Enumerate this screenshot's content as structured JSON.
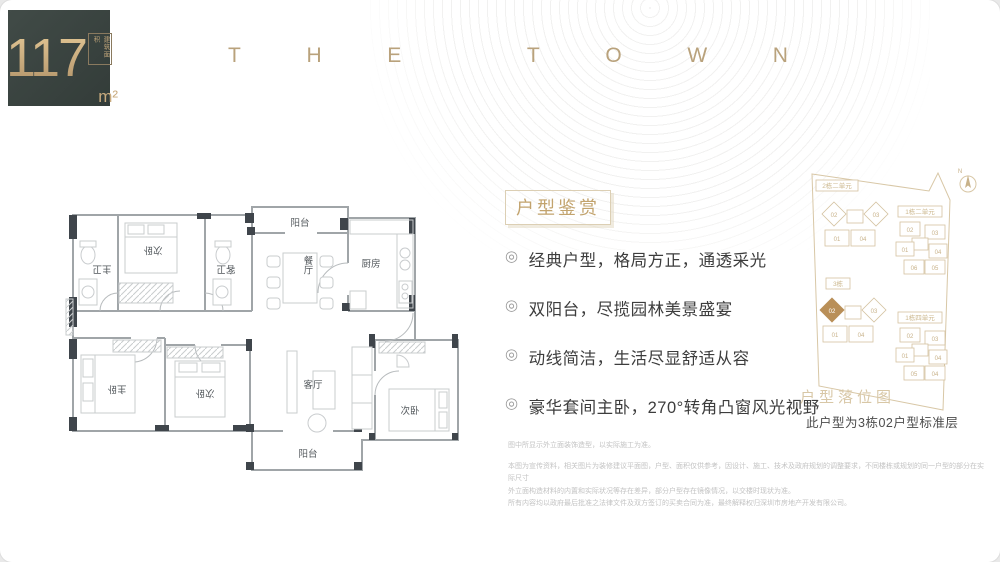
{
  "area_badge": {
    "value": "117",
    "unit": "m²",
    "note": "建筑面积"
  },
  "brand": {
    "letters": [
      "T",
      "H",
      "E",
      "T",
      "O",
      "W",
      "N"
    ]
  },
  "floorplan": {
    "rooms": {
      "balcony_top": "阳台",
      "dining": "餐厅",
      "kitchen": "厨房",
      "bedroom_top": "次卧",
      "master_bath": "主卫",
      "guest_bath": "客卫",
      "master_bed": "主卧",
      "bedroom_mid": "次卧",
      "living": "客厅",
      "bedroom_right": "次卧",
      "balcony_bottom": "阳台"
    }
  },
  "features": {
    "title": "户型鉴赏",
    "bullet_icon": "◎",
    "items": [
      "经典户型，格局方正，通透采光",
      "双阳台，尽揽园林美景盛宴",
      "动线简洁，生活尽显舒适从容",
      "豪华套间主卧，270°转角凸窗风光视野"
    ]
  },
  "sitemap": {
    "title": "户型落位图",
    "note": "此户型为3栋02户型标准层",
    "compass": "N",
    "clusters": [
      {
        "label": "2栋二单元",
        "units": [
          "02",
          "03",
          "01",
          "04"
        ]
      },
      {
        "label": "3栋",
        "units": [
          "02",
          "03",
          "01",
          "04"
        ],
        "highlight": "02"
      },
      {
        "label": "1栋二单元",
        "units": [
          "02",
          "03",
          "01",
          "04",
          "06",
          "05"
        ]
      },
      {
        "label": "1栋四单元",
        "units": [
          "02",
          "03",
          "01",
          "04",
          "05",
          "04"
        ]
      }
    ]
  },
  "disclaimer": {
    "line1": "图中所显示外立面装饰造型，以实际施工为准。",
    "line2": "本图为宣传资料，相关图片为装修建议平面图，户型、面积仅供参考，因设计、施工、技术及政府规划的调整要求，不同楼栋或规划的同一户型的部分在实际尺寸",
    "line3": "外立面构造材料的内置和实际状况等存在差异，部分户型存在镜像情况，以交楼时现状为准。",
    "line4": "所有内容均以政府最后批准之法律文件及双方签订的买卖合同为准，最终解释权归深圳市房地产开发有限公司。"
  }
}
